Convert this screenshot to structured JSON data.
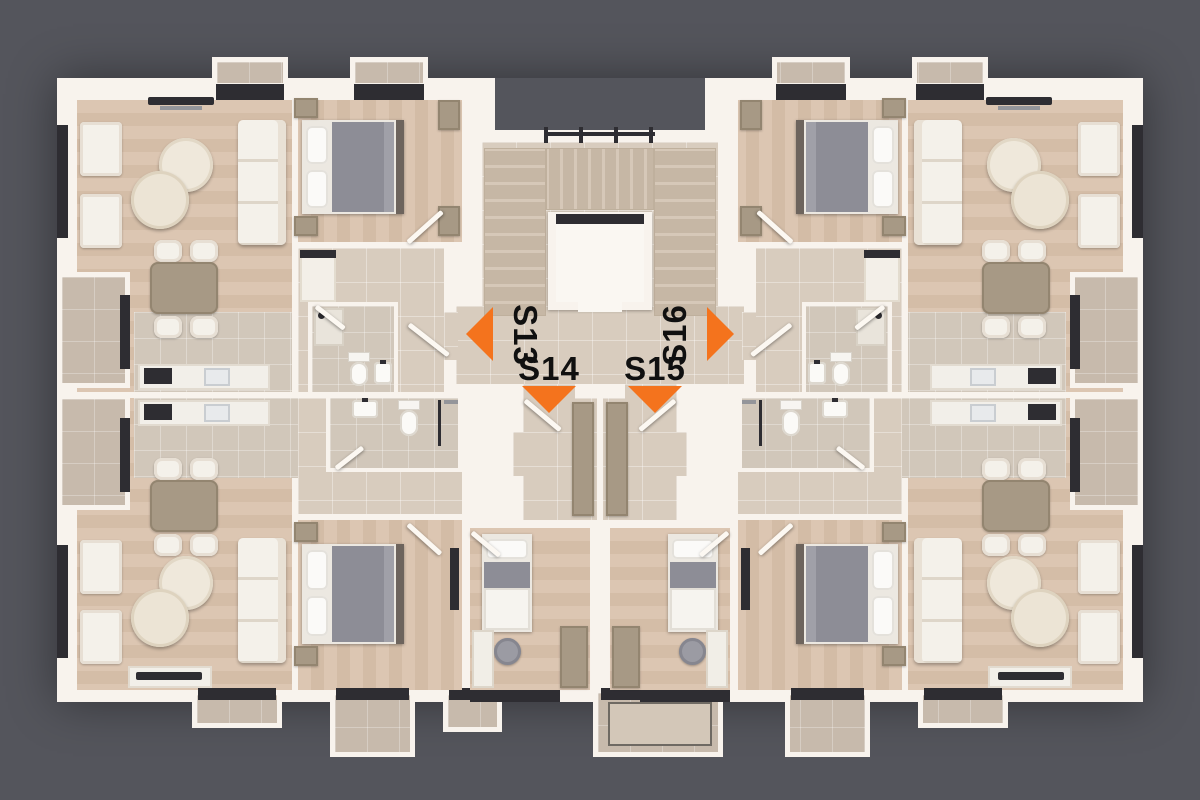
{
  "title": "apartment-floor-plan",
  "units": [
    {
      "id": "S13",
      "label": "S13",
      "arrow_direction": "left",
      "position": "top-left"
    },
    {
      "id": "S14",
      "label": "S14",
      "arrow_direction": "down",
      "position": "bottom-left"
    },
    {
      "id": "S15",
      "label": "S15",
      "arrow_direction": "down",
      "position": "bottom-right"
    },
    {
      "id": "S16",
      "label": "S16",
      "arrow_direction": "right",
      "position": "top-right"
    }
  ],
  "palette": {
    "background": "#54555c",
    "walls": "#f8f3ed",
    "wood_floor": "#d8c1ad",
    "tile_floor": "#d8ccbe",
    "balcony_stone": "#c7baac",
    "window_frames": "#2e2d32",
    "accent_arrow": "#f4731d",
    "label_text": "#101010"
  }
}
